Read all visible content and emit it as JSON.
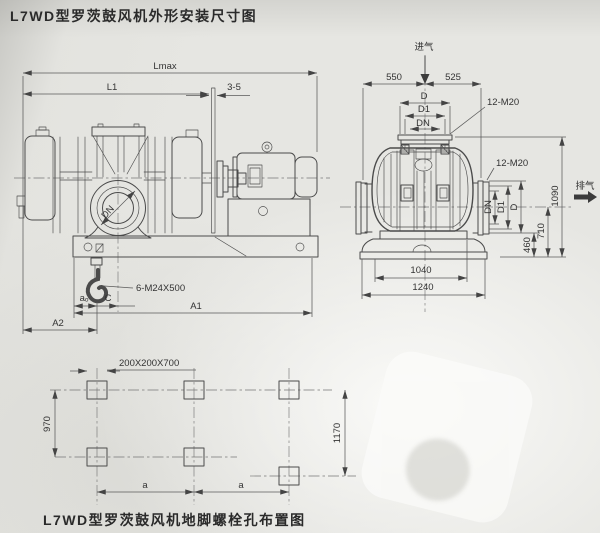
{
  "titles": {
    "top": "L7WD型罗茨鼓风机外形安装尺寸图",
    "bottom": "L7WD型罗茨鼓风机地脚螺栓孔布置图"
  },
  "side_view": {
    "lmax": "Lmax",
    "l1": "L1",
    "gap": "3-5",
    "anchor_bolt": "6-M24X500",
    "a0": "aₒ",
    "c": "C",
    "a1": "A1",
    "a2": "A2",
    "dn": "DN"
  },
  "end_view": {
    "inlet": "进气",
    "outlet": "排气",
    "left_offset": "550",
    "right_offset": "525",
    "d": "D",
    "d1": "D1",
    "dn": "DN",
    "bolts_top": "12-M20",
    "bolts_side": "12-M20",
    "side_dn": "DN",
    "side_d1": "D1",
    "side_d": "D",
    "h_port_bottom": "460",
    "h_port_center": "710",
    "h_total": "1090",
    "base_top_width": "1040",
    "base_bottom_width": "1240"
  },
  "foundation": {
    "hole_spec": "200X200X700",
    "pitch_left": "970",
    "pitch_right": "1170",
    "a_left": "a",
    "a_right": "a"
  }
}
